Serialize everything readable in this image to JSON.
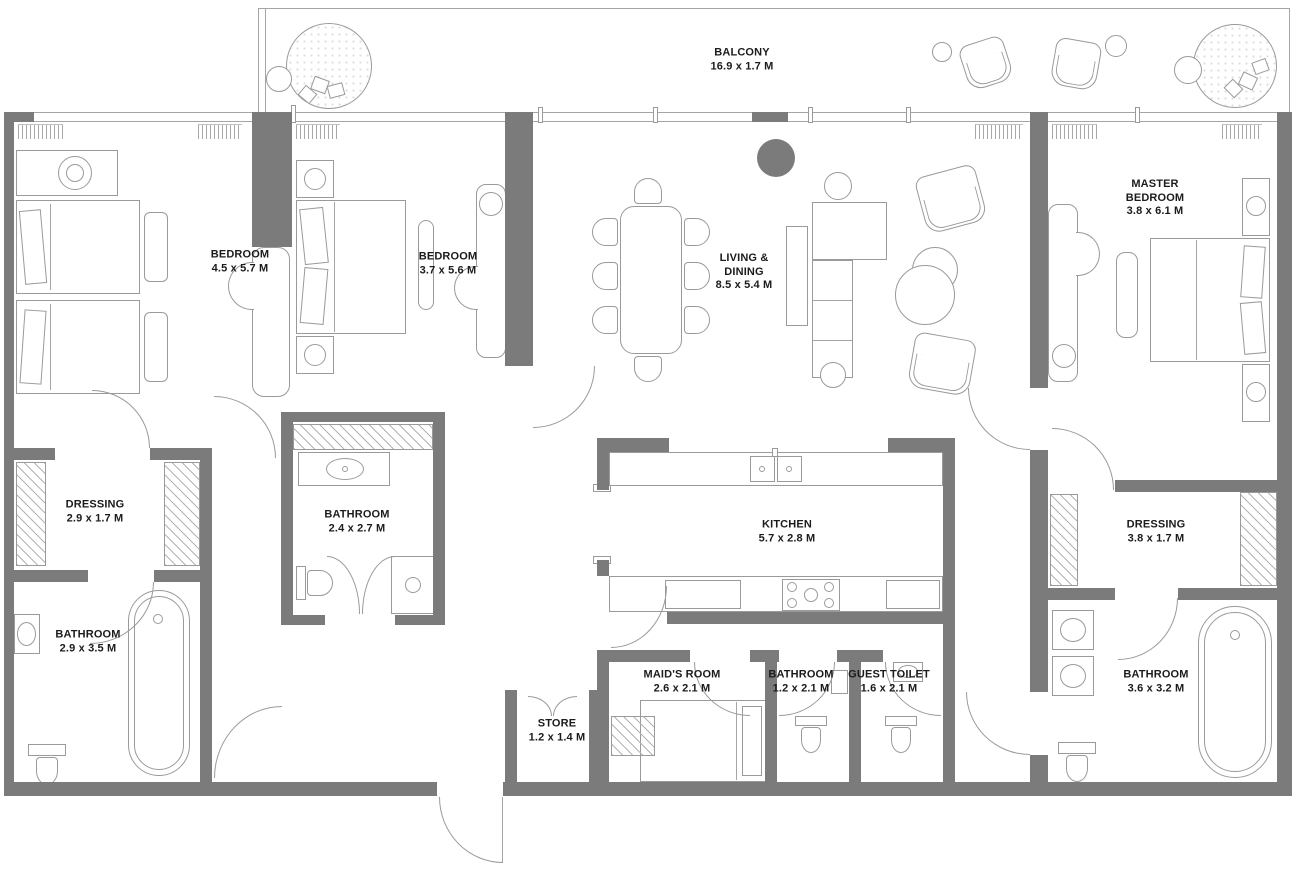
{
  "plan": {
    "type": "apartment-floor-plan",
    "colors": {
      "wall": "#7b7b7b",
      "line": "#9a9a9a",
      "text": "#1b1b1b",
      "background": "#ffffff"
    },
    "rooms": [
      {
        "id": "balcony",
        "name": "BALCONY",
        "dims": "16.9 x 1.7 M"
      },
      {
        "id": "bedroom-1",
        "name": "BEDROOM",
        "dims": "4.5 x 5.7 M"
      },
      {
        "id": "bedroom-2",
        "name": "BEDROOM",
        "dims": "3.7 x 5.6 M"
      },
      {
        "id": "living-dining",
        "name": "LIVING & DINING",
        "dims": "8.5 x 5.4 M"
      },
      {
        "id": "master-bedroom",
        "name": "MASTER BEDROOM",
        "dims": "3.8 x 6.1 M"
      },
      {
        "id": "dressing-1",
        "name": "DRESSING",
        "dims": "2.9 x 1.7 M"
      },
      {
        "id": "bathroom-1",
        "name": "BATHROOM",
        "dims": "2.4 x 2.7 M"
      },
      {
        "id": "bathroom-2",
        "name": "BATHROOM",
        "dims": "2.9 x 3.5 M"
      },
      {
        "id": "kitchen",
        "name": "KITCHEN",
        "dims": "5.7 x 2.8 M"
      },
      {
        "id": "dressing-2",
        "name": "DRESSING",
        "dims": "3.8 x 1.7 M"
      },
      {
        "id": "maids-room",
        "name": "MAID'S ROOM",
        "dims": "2.6 x 2.1 M"
      },
      {
        "id": "bathroom-3",
        "name": "BATHROOM",
        "dims": "1.2 x 2.1 M"
      },
      {
        "id": "guest-toilet",
        "name": "GUEST TOILET",
        "dims": "1.6 x 2.1 M"
      },
      {
        "id": "bathroom-4",
        "name": "BATHROOM",
        "dims": "3.6 x 3.2 M"
      },
      {
        "id": "store",
        "name": "STORE",
        "dims": "1.2 x 1.4 M"
      }
    ]
  }
}
